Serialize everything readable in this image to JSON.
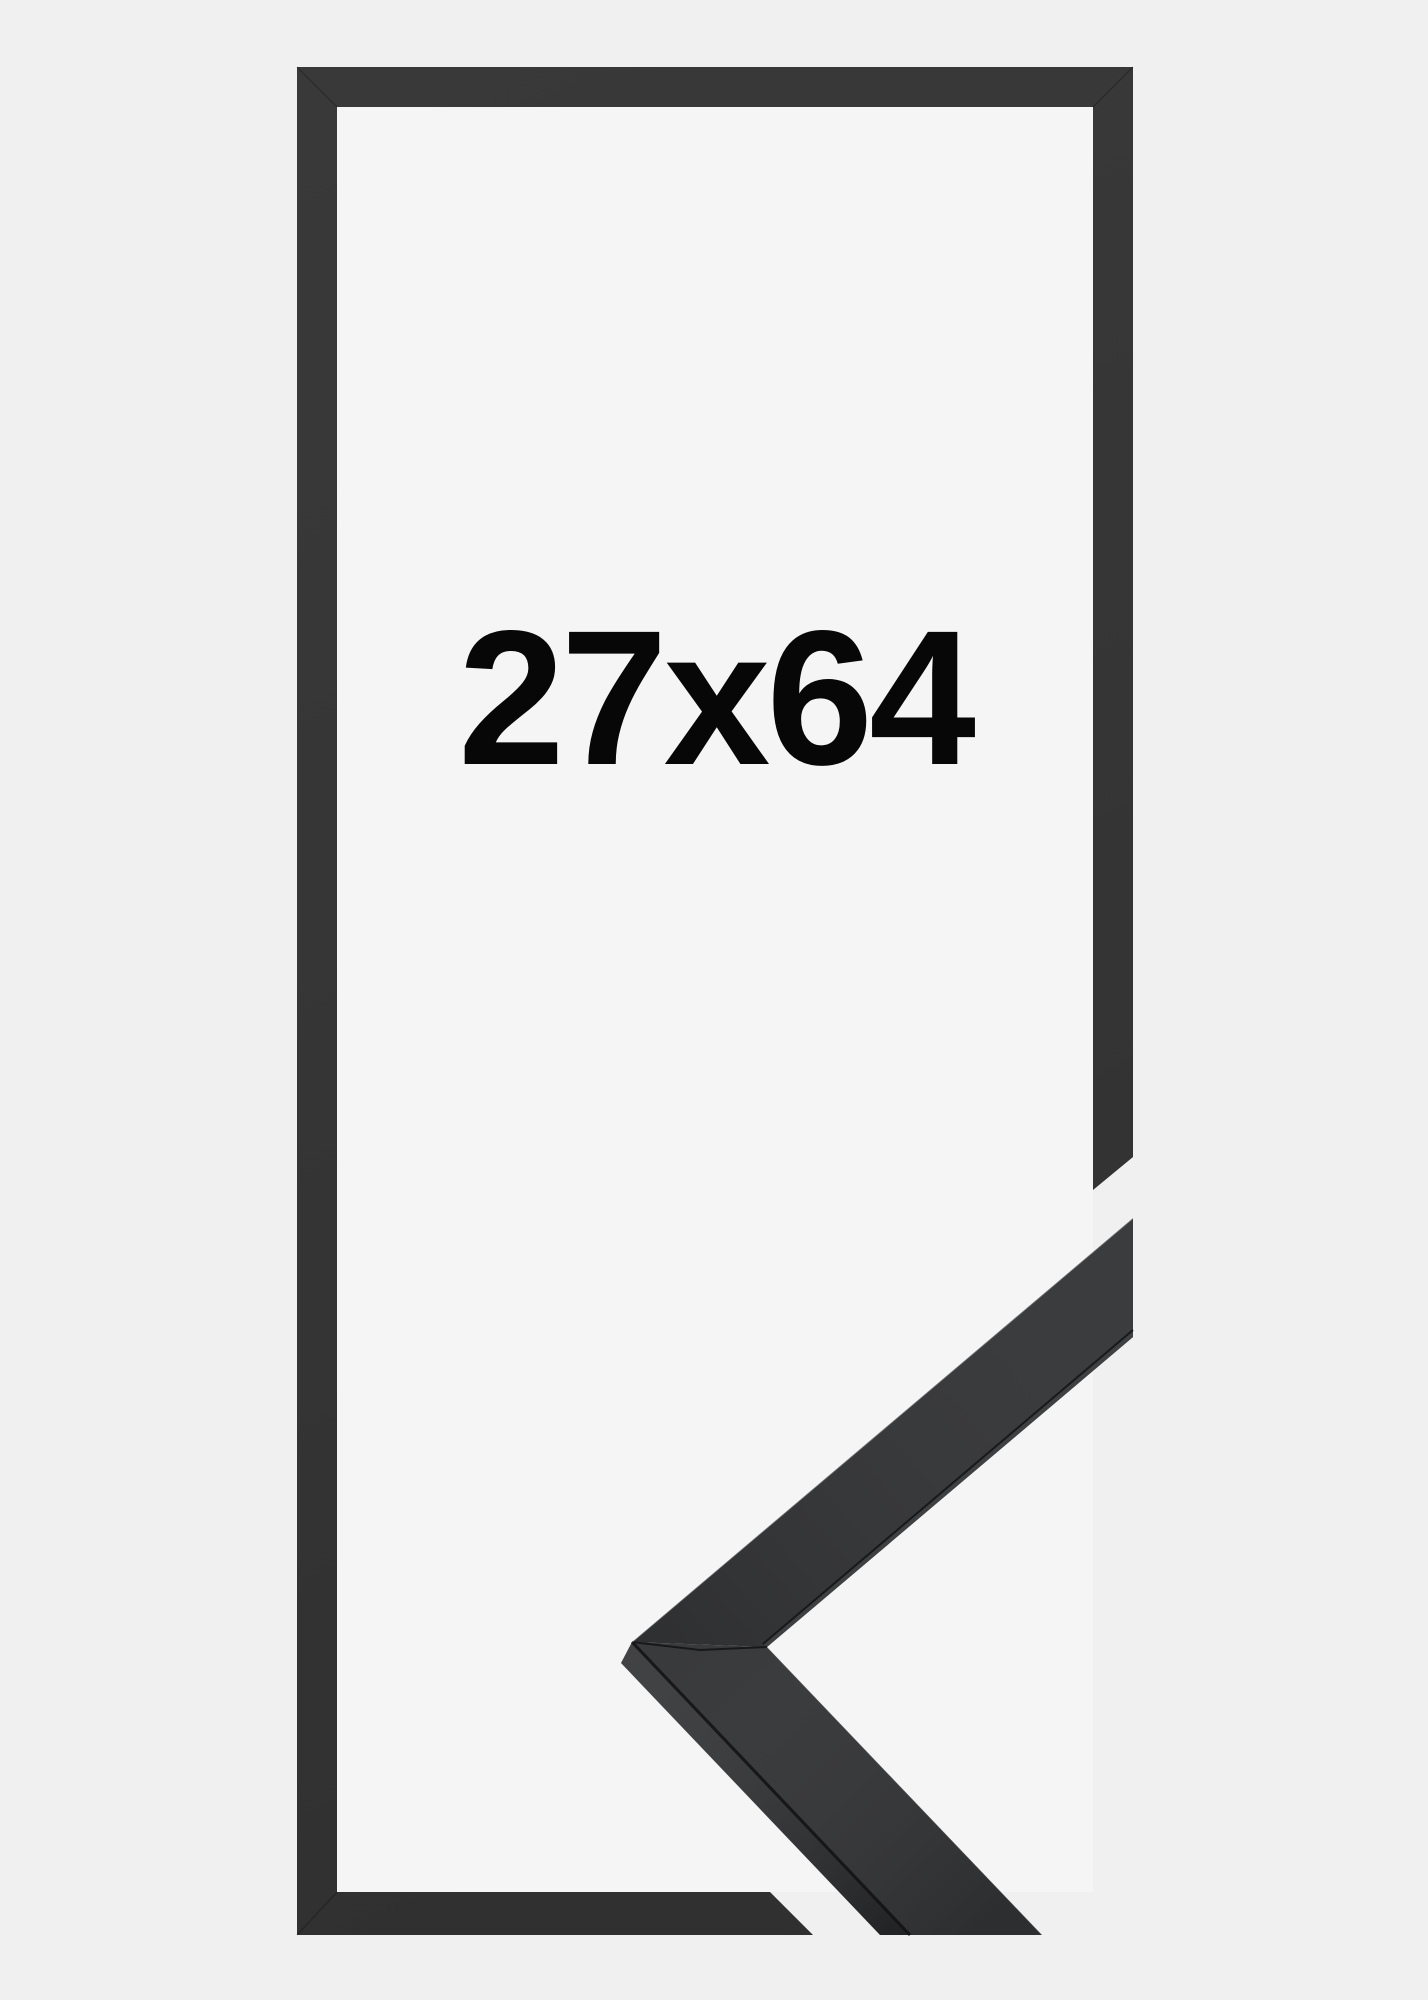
{
  "size_label": "27x64",
  "colors": {
    "background": "#f0f0f0",
    "window": "#f5f5f5",
    "frame": "#313131",
    "molding_front": "#333436",
    "molding_side": "#2c2d2f",
    "text": "#070707"
  }
}
